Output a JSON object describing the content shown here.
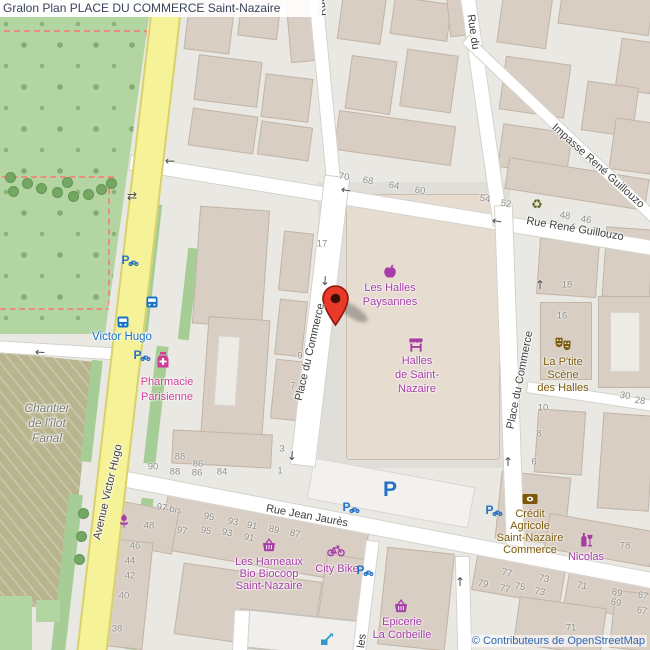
{
  "title": "Gralon Plan PLACE DU COMMERCE Saint-Nazaire",
  "attribution": "© Contributeurs de OpenStreetMap",
  "colors": {
    "marker_red": "#e8392b",
    "shop_purple": "#a73ba7",
    "pharmacy_pink": "#cf3d96",
    "amenity_brown": "#7a5a0a",
    "transport_blue": "#1673c9",
    "parking_blue": "#2472c8",
    "road_yellow": "#f6f297",
    "park_green": "#b2d5a1",
    "construction_khaki": "#b7b48e",
    "attribution_blue": "#2a66b8"
  },
  "streets": [
    {
      "t": "Rue René Guillouzo",
      "x": 575,
      "y": 229,
      "r": 9.5
    },
    {
      "t": "Impasse René Guillouzo",
      "x": 598,
      "y": 166,
      "r": 42
    },
    {
      "t": "Rue du",
      "x": 473,
      "y": 32,
      "r": 82
    },
    {
      "t": "Rue",
      "x": 322,
      "y": 6,
      "r": -96
    },
    {
      "t": "Place du Commerce",
      "x": 310,
      "y": 352,
      "r": -77
    },
    {
      "t": "Place du Commerce",
      "x": 520,
      "y": 380,
      "r": -79
    },
    {
      "t": "Rue Jean Jaurès",
      "x": 307,
      "y": 516,
      "r": 10.5
    },
    {
      "t": "Avenue Victor Hugo",
      "x": 108,
      "y": 492,
      "r": -77
    },
    {
      "t": "les",
      "x": 362,
      "y": 641,
      "r": -83
    }
  ],
  "area_labels": [
    {
      "name": "chantier-de-lilot-fanal",
      "lines": [
        "Chantier",
        "de l'îlot",
        "Fanal"
      ],
      "x": 47,
      "y": 408,
      "lh": 15,
      "color": "#7c7a70",
      "italic": true
    }
  ],
  "house_numbers": [
    [
      "70",
      344,
      177,
      9
    ],
    [
      "68",
      368,
      181,
      9
    ],
    [
      "64",
      394,
      186,
      9
    ],
    [
      "60",
      420,
      191,
      9
    ],
    [
      "54",
      485,
      199,
      9
    ],
    [
      "52",
      506,
      204,
      9
    ],
    [
      "48",
      565,
      216,
      9
    ],
    [
      "46",
      586,
      220,
      9
    ],
    [
      "17",
      322,
      244,
      0
    ],
    [
      "9",
      300,
      356,
      0
    ],
    [
      "7",
      293,
      386,
      0
    ],
    [
      "18",
      567,
      285,
      0
    ],
    [
      "16",
      562,
      316,
      0
    ],
    [
      "30",
      625,
      396,
      9
    ],
    [
      "28",
      640,
      401,
      9
    ],
    [
      "10",
      543,
      408,
      0
    ],
    [
      "8",
      539,
      434,
      0
    ],
    [
      "6",
      534,
      462,
      0
    ],
    [
      "90",
      153,
      467,
      0
    ],
    [
      "88",
      180,
      457,
      0
    ],
    [
      "86",
      198,
      464,
      0
    ],
    [
      "88",
      175,
      472,
      0
    ],
    [
      "86",
      197,
      473,
      0
    ],
    [
      "84",
      222,
      472,
      0
    ],
    [
      "3",
      282,
      449,
      0
    ],
    [
      "1",
      280,
      471,
      0
    ],
    [
      "97 bis",
      169,
      509,
      10
    ],
    [
      "95",
      209,
      517,
      10
    ],
    [
      "48",
      149,
      526,
      0
    ],
    [
      "97",
      182,
      531,
      10
    ],
    [
      "95",
      206,
      531,
      10
    ],
    [
      "93",
      233,
      522,
      10
    ],
    [
      "93",
      227,
      533,
      10
    ],
    [
      "91",
      252,
      526,
      10
    ],
    [
      "91",
      249,
      538,
      10
    ],
    [
      "89",
      274,
      530,
      10
    ],
    [
      "87",
      295,
      534,
      10
    ],
    [
      "46",
      135,
      546,
      0
    ],
    [
      "44",
      130,
      561,
      0
    ],
    [
      "42",
      130,
      576,
      0
    ],
    [
      "40",
      124,
      596,
      0
    ],
    [
      "38",
      117,
      629,
      0
    ],
    [
      "78",
      625,
      546,
      0
    ],
    [
      "77",
      507,
      573,
      10
    ],
    [
      "79",
      483,
      584,
      10
    ],
    [
      "77",
      505,
      589,
      10
    ],
    [
      "75",
      520,
      587,
      10
    ],
    [
      "73",
      544,
      579,
      10
    ],
    [
      "73",
      540,
      592,
      10
    ],
    [
      "71",
      582,
      586,
      10
    ],
    [
      "69",
      617,
      593,
      10
    ],
    [
      "69",
      616,
      603,
      10
    ],
    [
      "67",
      643,
      596,
      10
    ],
    [
      "67",
      642,
      611,
      10
    ],
    [
      "71",
      571,
      628,
      0
    ]
  ],
  "pois": [
    {
      "name": "les-halles-paysannes",
      "icon": "apple-icon",
      "color": "#a73ba7",
      "x": 390,
      "y": 271,
      "lx": 390,
      "ly": 288,
      "lh": 14,
      "lines": [
        "Les Halles",
        "Paysannes"
      ]
    },
    {
      "name": "halles-de-saint-nazaire",
      "icon": "market-icon",
      "color": "#a73ba7",
      "x": 416,
      "y": 345,
      "lx": 417,
      "ly": 361,
      "lh": 14,
      "lines": [
        "Halles",
        "de Saint-",
        "Nazaire"
      ]
    },
    {
      "name": "pharmacie-parisienne",
      "icon": "pharmacy-icon",
      "color": "#cf3d96",
      "x": 163,
      "y": 360,
      "lx": 167,
      "ly": 382,
      "lh": 15,
      "lines": [
        "Pharmacie",
        "Parisienne"
      ]
    },
    {
      "name": "la-ptite-scene-des-halles",
      "icon": "masks-icon",
      "color": "#7a5a0a",
      "x": 563,
      "y": 344,
      "lx": 563,
      "ly": 362,
      "lh": 13,
      "lines": [
        "La P'tite",
        "Scène",
        "des Halles"
      ]
    },
    {
      "name": "credit-agricole-saint-nazaire-commerce",
      "icon": "bank-icon",
      "color": "#7a5a0a",
      "x": 530,
      "y": 499,
      "lx": 530,
      "ly": 514,
      "lh": 12,
      "lines": [
        "Crédit",
        "Agricole",
        "Saint-Nazaire",
        "Commerce"
      ]
    },
    {
      "name": "nicolas",
      "icon": "wine-icon",
      "color": "#a73ba7",
      "x": 586,
      "y": 540,
      "lx": 586,
      "ly": 557,
      "lh": 13,
      "lines": [
        "Nicolas"
      ]
    },
    {
      "name": "les-hameaux-bio-biocoop",
      "icon": "basket-icon",
      "color": "#a73ba7",
      "x": 269,
      "y": 545,
      "lx": 269,
      "ly": 562,
      "lh": 12,
      "lines": [
        "Les Hameaux",
        "Bio Biocoop",
        "Saint-Nazaire"
      ]
    },
    {
      "name": "city-bike",
      "icon": "bicycle-icon",
      "color": "#a73ba7",
      "x": 336,
      "y": 551,
      "lx": 337,
      "ly": 569,
      "lh": 13,
      "lines": [
        "City Bike"
      ]
    },
    {
      "name": "epicerie-la-corbeille",
      "icon": "basket-icon",
      "color": "#a73ba7",
      "x": 401,
      "y": 606,
      "lx": 402,
      "ly": 622,
      "lh": 13,
      "lines": [
        "Epicerie",
        "La Corbeille"
      ]
    },
    {
      "name": "bus-stop-victor-hugo",
      "color": "#1673c9",
      "x": 122,
      "y": 337,
      "lx": 122,
      "ly": 337,
      "lh": 13,
      "size": 11.5,
      "lines": [
        "Victor Hugo"
      ]
    },
    {
      "name": "recycling-point",
      "icon": "recycle-icon",
      "color": "#63631c",
      "x": 537,
      "y": 205
    },
    {
      "name": "florist",
      "icon": "flower-icon",
      "color": "#a73ba7",
      "x": 124,
      "y": 521
    },
    {
      "name": "construction-works",
      "icon": "works-icon",
      "color": "#2d9ac9",
      "x": 327,
      "y": 639
    },
    {
      "name": "bus-stop",
      "icon": "bus-icon",
      "color": "#1673c9",
      "x": 152,
      "y": 302
    },
    {
      "name": "bus-stop",
      "icon": "bus-icon",
      "color": "#1673c9",
      "x": 123,
      "y": 322
    },
    {
      "name": "bicycle-parking",
      "icon": "bike-parking-icon",
      "color": "#2472c8",
      "x": 130,
      "y": 261
    },
    {
      "name": "bicycle-parking",
      "icon": "bike-parking-icon",
      "color": "#2472c8",
      "x": 142,
      "y": 356
    },
    {
      "name": "bicycle-parking",
      "icon": "bike-parking-icon",
      "color": "#2472c8",
      "x": 351,
      "y": 508
    },
    {
      "name": "bicycle-parking",
      "icon": "bike-parking-icon",
      "color": "#2472c8",
      "x": 494,
      "y": 511
    },
    {
      "name": "bicycle-parking",
      "icon": "bike-parking-icon",
      "color": "#2472c8",
      "x": 365,
      "y": 571
    },
    {
      "name": "parking",
      "icon": "parking-icon",
      "color": "#2472c8",
      "x": 390,
      "y": 490
    }
  ],
  "arrows": [
    [
      "←",
      170,
      161,
      0
    ],
    [
      "←",
      346,
      190,
      9
    ],
    [
      "←",
      497,
      221,
      9
    ],
    [
      "↓",
      325,
      281,
      4
    ],
    [
      "↓",
      292,
      456,
      4
    ],
    [
      "↑",
      540,
      285,
      0
    ],
    [
      "↑",
      508,
      462,
      0
    ],
    [
      "←",
      40,
      352,
      3
    ],
    [
      "⇄",
      132,
      196,
      0
    ],
    [
      "↑",
      460,
      582,
      0
    ]
  ]
}
